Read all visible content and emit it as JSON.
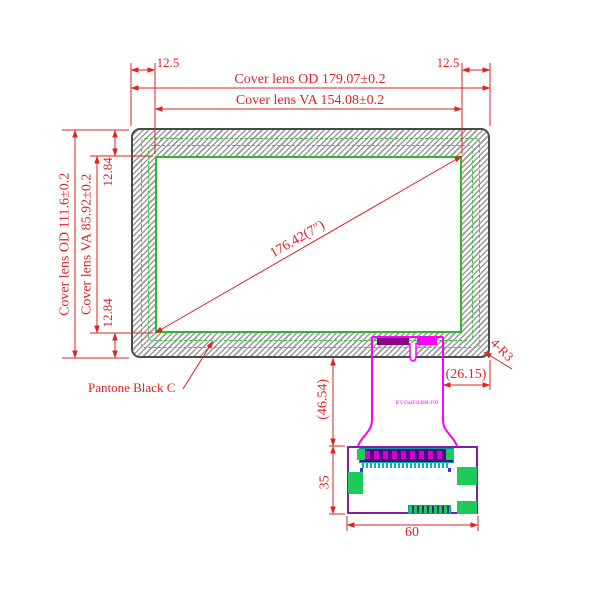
{
  "drawing": {
    "type": "mechanical drawing of 7 inch cover lens touch panel with FPC tail and PCB",
    "dimensions": {
      "top_margin_left": "12.5",
      "top_margin_right": "12.5",
      "cover_od_width": "Cover lens OD 179.07±0.2",
      "cover_va_width": "Cover lens VA 154.08±0.2",
      "cover_od_height": "Cover lens OD 111.6±0.2",
      "cover_va_height": "Cover lens VA 85.92±0.2",
      "side_margin_top": "12.84",
      "side_margin_bottom": "12.84",
      "diagonal": "176.42(7″)",
      "corner_radius": "4-R3",
      "fpc_right_offset": "(26.15)",
      "fpc_length": "(46.54)",
      "pcb_height": "35",
      "pcb_width": "60"
    },
    "labels": {
      "bezel_color": "Pantone Black C",
      "fpc_marking": "KY-Da4F4LRM-T09"
    },
    "colors": {
      "dimension_red": "#e32222",
      "fpc_magenta": "#ff00ff",
      "fpc_dark_bar": "#8b008b",
      "pcb_purple": "#7d1fa8",
      "pad_green": "#1ecb5a",
      "va_border_green": "#2db92d",
      "hatch_gray": "#9b9b9b",
      "outline_gray": "#4a4a4a"
    }
  }
}
